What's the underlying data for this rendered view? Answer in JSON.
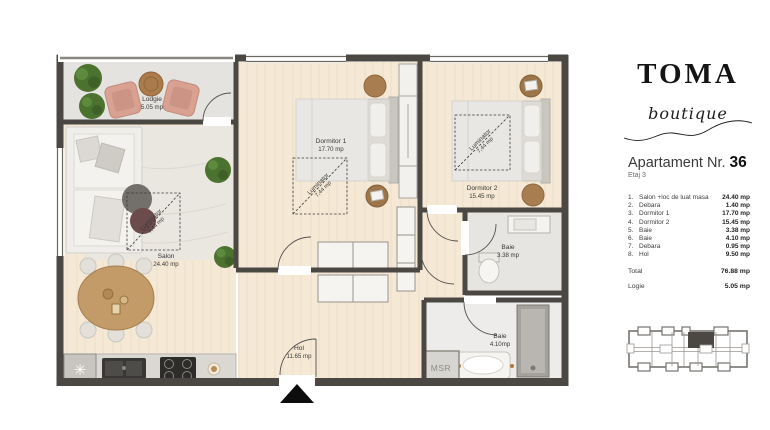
{
  "brand": {
    "name": "TOMA",
    "tagline": "boutique"
  },
  "apartment": {
    "title_prefix": "Apartament Nr.",
    "number": "36",
    "floor": "Etaj 3",
    "rooms": [
      {
        "nr": "1.",
        "name": "Salon +loc de luat masa",
        "area": "24.40 mp"
      },
      {
        "nr": "2.",
        "name": "Debara",
        "area": "1.40 mp"
      },
      {
        "nr": "3.",
        "name": "Dormitor 1",
        "area": "17.70 mp"
      },
      {
        "nr": "4.",
        "name": "Dormitor 2",
        "area": "15.45 mp"
      },
      {
        "nr": "5.",
        "name": "Baie",
        "area": "3.38 mp"
      },
      {
        "nr": "6.",
        "name": "Baie",
        "area": "4.10 mp"
      },
      {
        "nr": "7.",
        "name": "Debara",
        "area": "0.95 mp"
      },
      {
        "nr": "8.",
        "name": "Hol",
        "area": "9.50 mp"
      }
    ],
    "total_label": "Total",
    "total_area": "76.88 mp",
    "logie_label": "Logie",
    "logie_area": "5.05 mp"
  },
  "plan": {
    "labels": {
      "lodgie": {
        "name": "Lodgie",
        "area": "5.05 mp"
      },
      "salon": {
        "name": "Salon",
        "area": "24.40 mp"
      },
      "dormitor1": {
        "name": "Dormitor 1",
        "area": "17.70 mp"
      },
      "dormitor2": {
        "name": "Dormitor 2",
        "area": "15.45 mp"
      },
      "baie1": {
        "name": "Baie",
        "area": "3.38 mp"
      },
      "baie2": {
        "name": "Baie",
        "area": "4.10mp"
      },
      "hol": {
        "name": "Hol",
        "area": "11.65 mp"
      },
      "msr": "MSR",
      "luminator": {
        "name": "Luminator",
        "area": "7,44 mp"
      }
    },
    "symbols": {
      "fridge": "✳"
    },
    "colors": {
      "brand_ink": "#141414",
      "wall": "#4b4844",
      "wood_floor": "#f5e9d6",
      "tile_floor": "#e4e3e0",
      "armchair_accent": "#d79e8e",
      "plant": "#4f7d35",
      "keyplan_highlight": "#4b4844"
    }
  }
}
